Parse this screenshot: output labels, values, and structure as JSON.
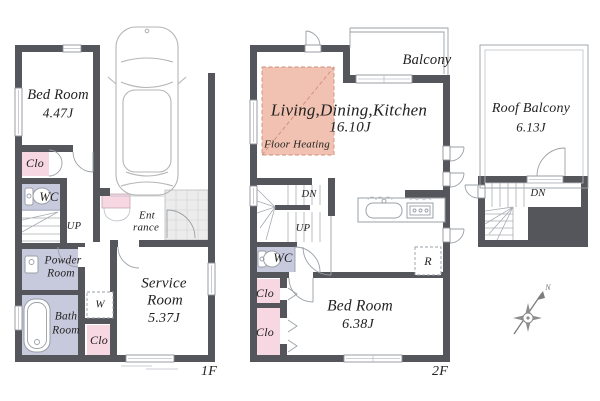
{
  "colors": {
    "wall": "#55565c",
    "closet_pink": "#f7d7e2",
    "sanitary_lavender": "#c7c9dd",
    "floor_heating": "#f1c2b1",
    "floor_heating_line": "#cf8d7a",
    "tile": "#ececec",
    "text": "#222222"
  },
  "floor1": {
    "label": "1F",
    "bedroom_name": "Bed Room",
    "bedroom_size": "4.47J",
    "closet_bedroom": "Clo",
    "wc": "WC",
    "stairs_up": "UP",
    "powder_line1": "Powder",
    "powder_line2": "Room",
    "bath_line1": "Bath",
    "bath_line2": "Room",
    "washer": "W",
    "closet_hall": "Clo",
    "service_line1": "Service",
    "service_line2": "Room",
    "service_size": "5.37J",
    "entrance_line1": "Ent",
    "entrance_line2": "rance"
  },
  "floor2": {
    "label": "2F",
    "balcony": "Balcony",
    "ldk_name": "Living,Dining,Kitchen",
    "ldk_size": "16.10J",
    "floor_heating": "Floor Heating",
    "stairs_down": "DN",
    "stairs_up": "UP",
    "wc": "WC",
    "closet_upper": "Clo",
    "closet_lower": "Clo",
    "bedroom_name": "Bed Room",
    "bedroom_size": "6.38J",
    "refrigerator": "R"
  },
  "roof": {
    "balcony_name": "Roof Balcony",
    "balcony_size": "6.13J",
    "stairs_down": "DN",
    "compass_north": "N"
  }
}
